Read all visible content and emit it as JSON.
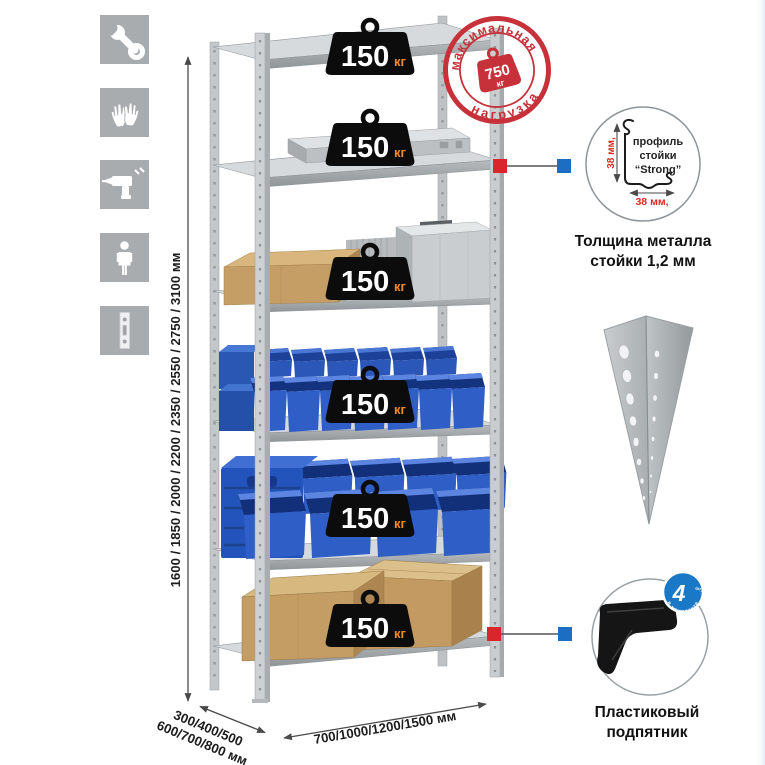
{
  "page": {
    "background": "#ffffff"
  },
  "colors": {
    "icon_bg": "#a8acaf",
    "callout_red": "#d9262c",
    "callout_blue": "#1b6ec2",
    "stamp_red": "#c6313a",
    "badge_blue": "#1a78c6",
    "dim_red": "#d92b22",
    "bin_blue": "#2e5ec6",
    "metal_gray": "#ccd0d2",
    "cardboard": "#c5a06b"
  },
  "sidebar": {
    "icons": [
      {
        "name": "wrench"
      },
      {
        "name": "gloves"
      },
      {
        "name": "drill"
      },
      {
        "name": "person"
      },
      {
        "name": "profile-strip"
      }
    ]
  },
  "dimensions": {
    "height_label": "1600 / 1850 / 2000 / 2200 / 2350 / 2550 / 2750 / 3100 мм",
    "depth_label_line1": "300/400/500",
    "depth_label_line2": "600/700/800 мм",
    "width_label": "700/1000/1200/1500 мм"
  },
  "rack": {
    "shelves": [
      {
        "load": "150",
        "unit": "кг"
      },
      {
        "load": "150",
        "unit": "кг"
      },
      {
        "load": "150",
        "unit": "кг"
      },
      {
        "load": "150",
        "unit": "кг"
      },
      {
        "load": "150",
        "unit": "кг"
      },
      {
        "load": "150",
        "unit": "кг"
      }
    ]
  },
  "max_load_stamp": {
    "arc_top": "максимальная",
    "arc_bottom": "нагрузка",
    "value": "750",
    "unit": "кг"
  },
  "profile_detail": {
    "label_line1": "профиль",
    "label_line2": "стойки",
    "label_line3": "“Strong”",
    "dim_vertical": "38 мм,",
    "dim_horizontal": "38 мм,",
    "caption_line1": "Толщина металла",
    "caption_line2": "стойки 1,2 мм"
  },
  "foot_detail": {
    "caption_line1": "Пластиковый",
    "caption_line2": "подпятник",
    "badge_value": "4",
    "badge_unit": "штуки",
    "badge_arc": "в комплекте"
  }
}
